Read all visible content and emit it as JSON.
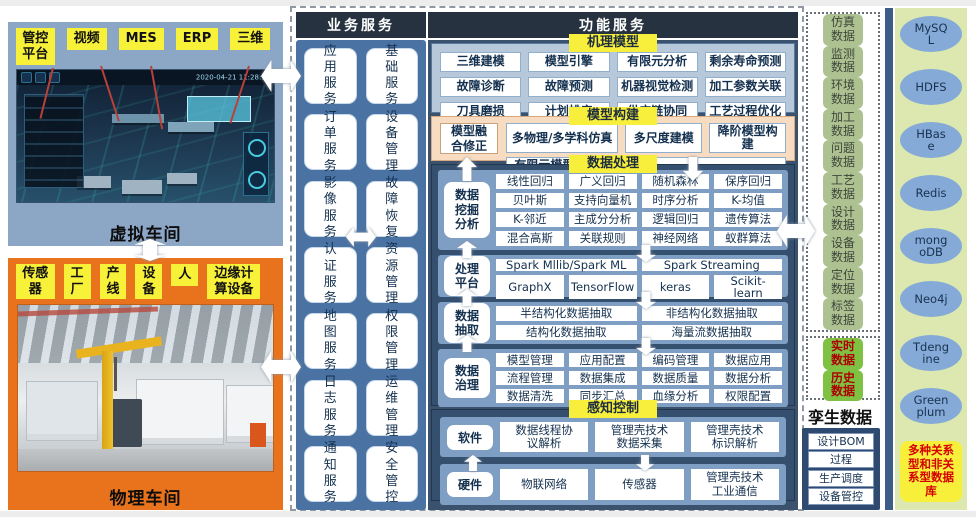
{
  "left_panels": {
    "virtual": {
      "chips": [
        "管控平台",
        "视频",
        "MES",
        "ERP",
        "三维"
      ],
      "screen_time": "2020-04-21 11:28:14",
      "caption": "虚拟车间"
    },
    "physical": {
      "chips": [
        "传感器",
        "工厂",
        "产线",
        "设备",
        "人",
        "边缘计算设备"
      ],
      "caption": "物理车间"
    }
  },
  "business_services": {
    "title": "业务服务",
    "col1": [
      "应用服务",
      "订单服务",
      "影像服务",
      "认证服务",
      "地图服务",
      "日志服务",
      "通知服务"
    ],
    "col2": [
      "基础服务",
      "设备管理",
      "故障恢复",
      "资源管理",
      "权限管理",
      "运维管理",
      "安全管控"
    ]
  },
  "functional_services": {
    "title": "功能服务",
    "mechanism_model": {
      "tag": "机理模型",
      "rows": [
        [
          "三维建模",
          "模型引擎",
          "有限元分析",
          "剩余寿命预测"
        ],
        [
          "故障诊断",
          "故障预测",
          "机器视觉检测",
          "加工参数关联"
        ],
        [
          "刀具磨损",
          "计划排产",
          "供应链协同",
          "工艺过程优化"
        ]
      ]
    },
    "model_building": {
      "tag": "模型构建",
      "side": "模型融合修正",
      "rows": [
        [
          "多物理/多学科仿真",
          "多尺度建模",
          "降阶模型构建"
        ],
        [
          "有限元模型修正",
          "在线学习",
          "增量学习"
        ]
      ]
    },
    "data_processing": {
      "tag": "数据处理",
      "panels": [
        {
          "label": "数据挖掘分析",
          "rows": [
            [
              "线性回归",
              "广义回归",
              "随机森林",
              "保序回归"
            ],
            [
              "贝叶斯",
              "支持向量机",
              "时序分析",
              "K-均值"
            ],
            [
              "K-邻近",
              "主成分分析",
              "逻辑回归",
              "遗传算法"
            ],
            [
              "混合高斯",
              "关联规则",
              "神经网络",
              "蚁群算法"
            ]
          ]
        },
        {
          "label": "处理平台",
          "rows": [
            [
              "Spark Mllib/Spark ML",
              "Spark Streaming"
            ],
            [
              "GraphX",
              "TensorFlow",
              "keras",
              "Scikit-learn"
            ]
          ]
        },
        {
          "label": "数据抽取",
          "rows": [
            [
              "半结构化数据抽取",
              "非结构化数据抽取"
            ],
            [
              "结构化数据抽取",
              "海量流数据抽取"
            ]
          ]
        },
        {
          "label": "数据治理",
          "rows": [
            [
              "模型管理",
              "应用配置",
              "编码管理",
              "数据应用"
            ],
            [
              "流程管理",
              "数据集成",
              "数据质量",
              "数据分析"
            ],
            [
              "数据清洗",
              "同步汇总",
              "血缘分析",
              "权限配置"
            ]
          ]
        }
      ]
    },
    "perception_control": {
      "tag": "感知控制",
      "rows": [
        {
          "label": "软件",
          "items": [
            "数据线程协议解析",
            "管理壳技术数据采集",
            "管理壳技术标识解析"
          ]
        },
        {
          "label": "硬件",
          "items": [
            "物联网络",
            "传感器",
            "管理壳技术工业通信"
          ]
        }
      ]
    }
  },
  "twin_data": {
    "categories": [
      "仿真数据",
      "监测数据",
      "环境数据",
      "加工数据",
      "问题数据",
      "工艺数据",
      "设计数据",
      "设备数据",
      "定位数据",
      "标签数据"
    ],
    "realtime": [
      "实时数据",
      "历史数据"
    ],
    "caption": "孪生数据",
    "processes": [
      "设计BOM",
      "过程",
      "生产调度",
      "设备管控"
    ]
  },
  "databases": {
    "engines": [
      "MySQL",
      "HDFS",
      "HBase",
      "Redis",
      "mongoDB",
      "Neo4j",
      "Tdengine",
      "Greenplum"
    ],
    "note": "多种关系型和非关系型数据库"
  },
  "colors": {
    "accent_yellow": "#f7ef3c",
    "header_navy": "#26323f",
    "virtual_panel_blue": "#8ca7c6",
    "physical_panel_orange": "#e9731d",
    "business_blue": "#4a72a2",
    "model_building_peach": "#f8dcc2",
    "dark_section_navy": "#35506f",
    "data_category_green": "#aec291",
    "realtime_green": "#7fc142",
    "realtime_text_red": "#ad0000",
    "db_panel_green": "#dce8af",
    "db_ellipse_blue": "#86aad8"
  }
}
